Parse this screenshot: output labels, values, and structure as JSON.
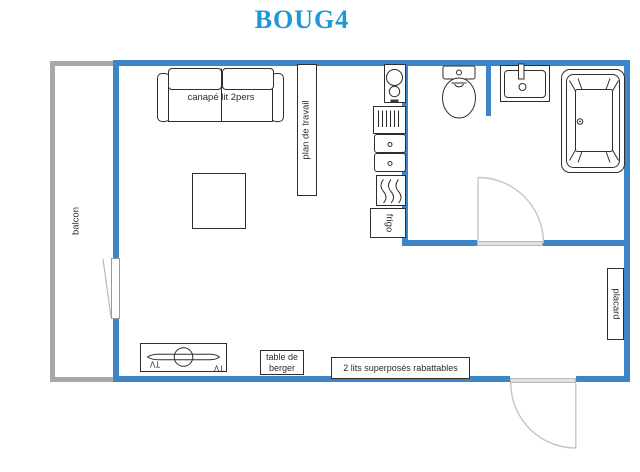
{
  "title": "BOUG4",
  "colors": {
    "wall": "#3d85c6",
    "balcony_wall": "#a8a8a8",
    "title_text": "#1e97d4",
    "door": "#c4c4c4"
  },
  "rooms": {
    "balcony_label": "balcon",
    "closet_label": "placard"
  },
  "furniture": {
    "sofa_label": "canapé lit 2pers",
    "worktop_label": "plan de travail",
    "fridge_label": "frigo",
    "tv_label": "TV",
    "shepherd_table_label": "table de berger",
    "bunk_beds_label": "2 lits superposés rabattables"
  }
}
